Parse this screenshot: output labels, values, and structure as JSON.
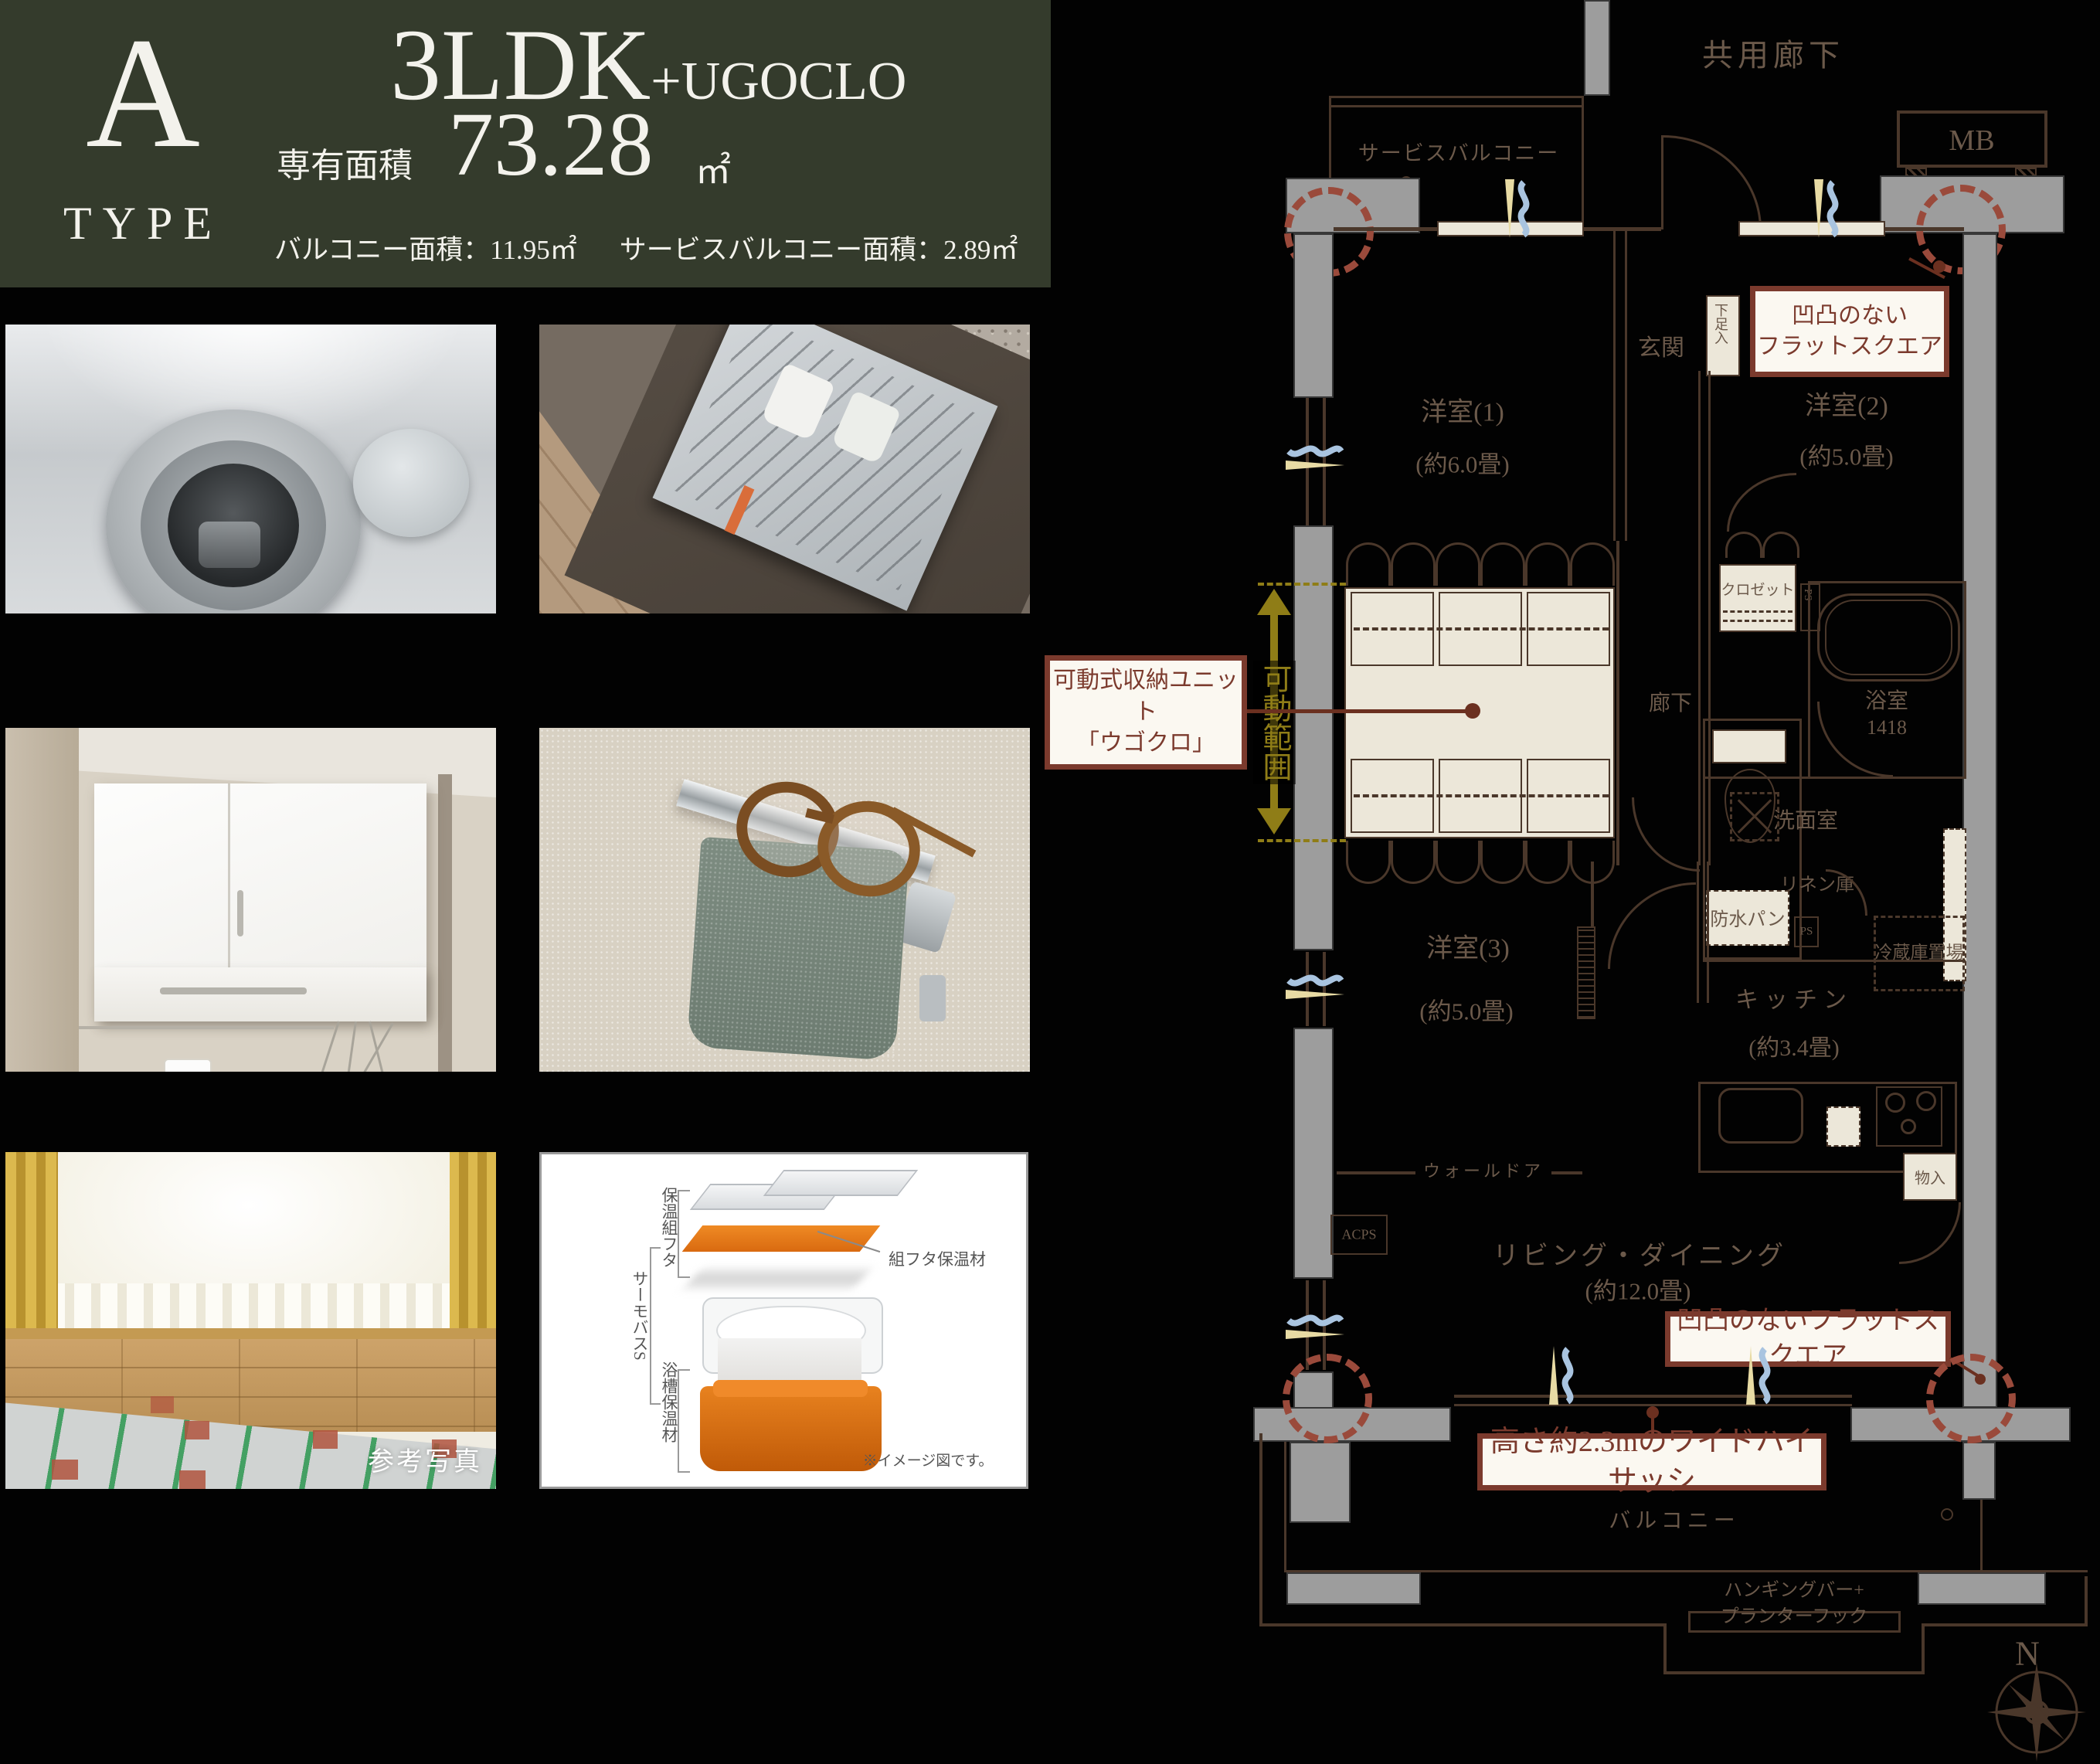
{
  "colors": {
    "header_bg": "#343b2c",
    "accent_red": "#7b3a2d",
    "dashed_red": "#9a4a3b",
    "olive": "#8f7d17",
    "wall_gray": "#9d9d9d",
    "cream": "#ece7d9",
    "line": "#4a372a",
    "label": "#6b594a"
  },
  "header": {
    "type_letter": "A",
    "type_word": "TYPE",
    "plan": "3LDK",
    "plan_suffix": "+UGOCLO",
    "area_label": "専有面積",
    "area_value": "73.28",
    "area_unit": "㎡",
    "balcony": "バルコニー面積：11.95㎡",
    "service_balcony": "サービスバルコニー面積：2.89㎡"
  },
  "photos": {
    "reference": "参考写真"
  },
  "bath_diagram": {
    "lid": "保温組フタ",
    "thermo": "サーモバスS",
    "tub_ins": "浴槽保温材",
    "lid_ins": "組フタ保温材",
    "note": "※イメージ図です。"
  },
  "plan": {
    "kyoyo": "共用廊下",
    "service_balcony": "サービスバルコニー",
    "mb": "MB",
    "genkan": "玄関",
    "shoe": "下足入",
    "r1": "洋室(1)",
    "r1s": "(約6.0畳)",
    "r2": "洋室(2)",
    "r2s": "(約5.0畳)",
    "closet": "クロゼット",
    "ps": "PS",
    "rouka": "廊下",
    "bath": "浴室",
    "bath_size": "1418",
    "toilet": "トイレ",
    "wash": "洗面室",
    "linen": "リネン庫",
    "pan": "防水パン",
    "fridge": "冷蔵庫置場",
    "kitchen": "キッチン",
    "kitchens": "(約3.4畳)",
    "r3": "洋室(3)",
    "r3s": "(約5.0畳)",
    "walldoor": "ウォールドア",
    "acps": "ACPS",
    "mono": "物入",
    "ld": "リビング・ダイニング",
    "lds": "(約12.0畳)",
    "balcony": "バルコニー",
    "hang1": "ハンギングバー+",
    "hang2": "プランターフック",
    "north": "N"
  },
  "callouts": {
    "flat1a": "凹凸のない",
    "flat1b": "フラットスクエア",
    "ugo1": "可動式収納ユニット",
    "ugo2": "「ウゴクロ」",
    "range": "可動範囲",
    "flat2": "凹凸のないフラットスクエア",
    "sash": "高さ約2.3mのワイドハイサッシ"
  }
}
